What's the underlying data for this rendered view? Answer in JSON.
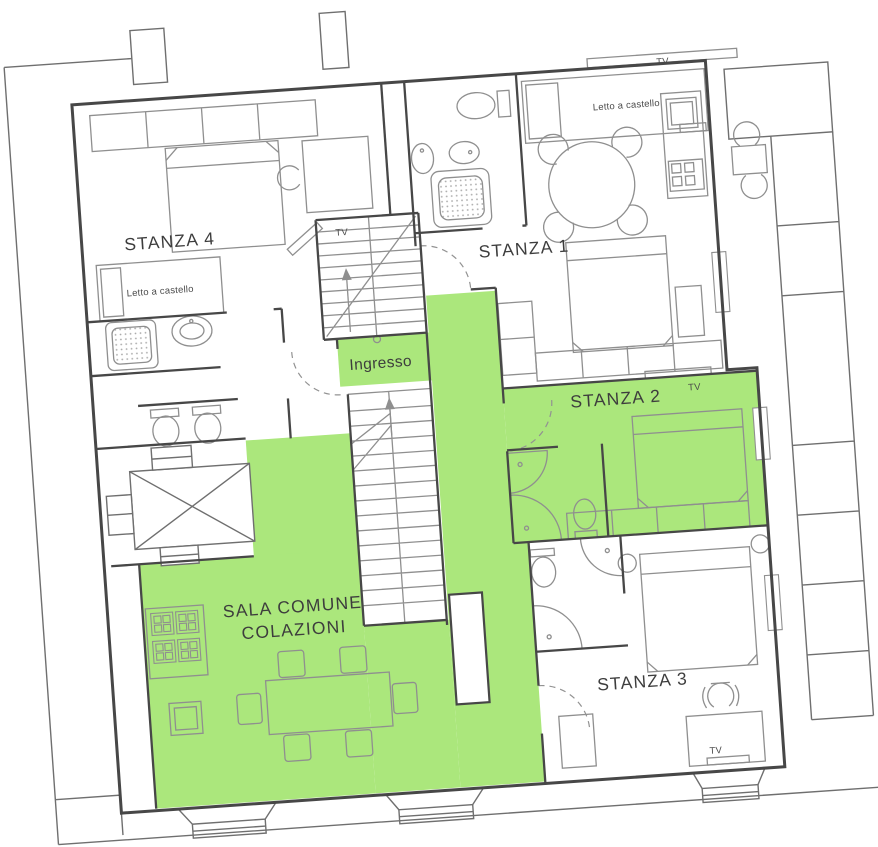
{
  "plan": {
    "colors": {
      "highlight": "#abe77c",
      "wall": "#474747",
      "furniture": "#8f8f8f",
      "text": "#3d3d3d"
    },
    "rooms": {
      "stanza1": {
        "label": "STANZA 1"
      },
      "stanza2": {
        "label": "STANZA 2"
      },
      "stanza3": {
        "label": "STANZA 3"
      },
      "stanza4": {
        "label": "STANZA 4"
      },
      "ingresso": {
        "label": "Ingresso"
      },
      "sala_comune": {
        "line1": "SALA COMUNE",
        "line2": "COLAZIONI"
      }
    },
    "furniture": {
      "bunk_bed_label": "Letto a castello",
      "tv_label": "TV"
    }
  }
}
